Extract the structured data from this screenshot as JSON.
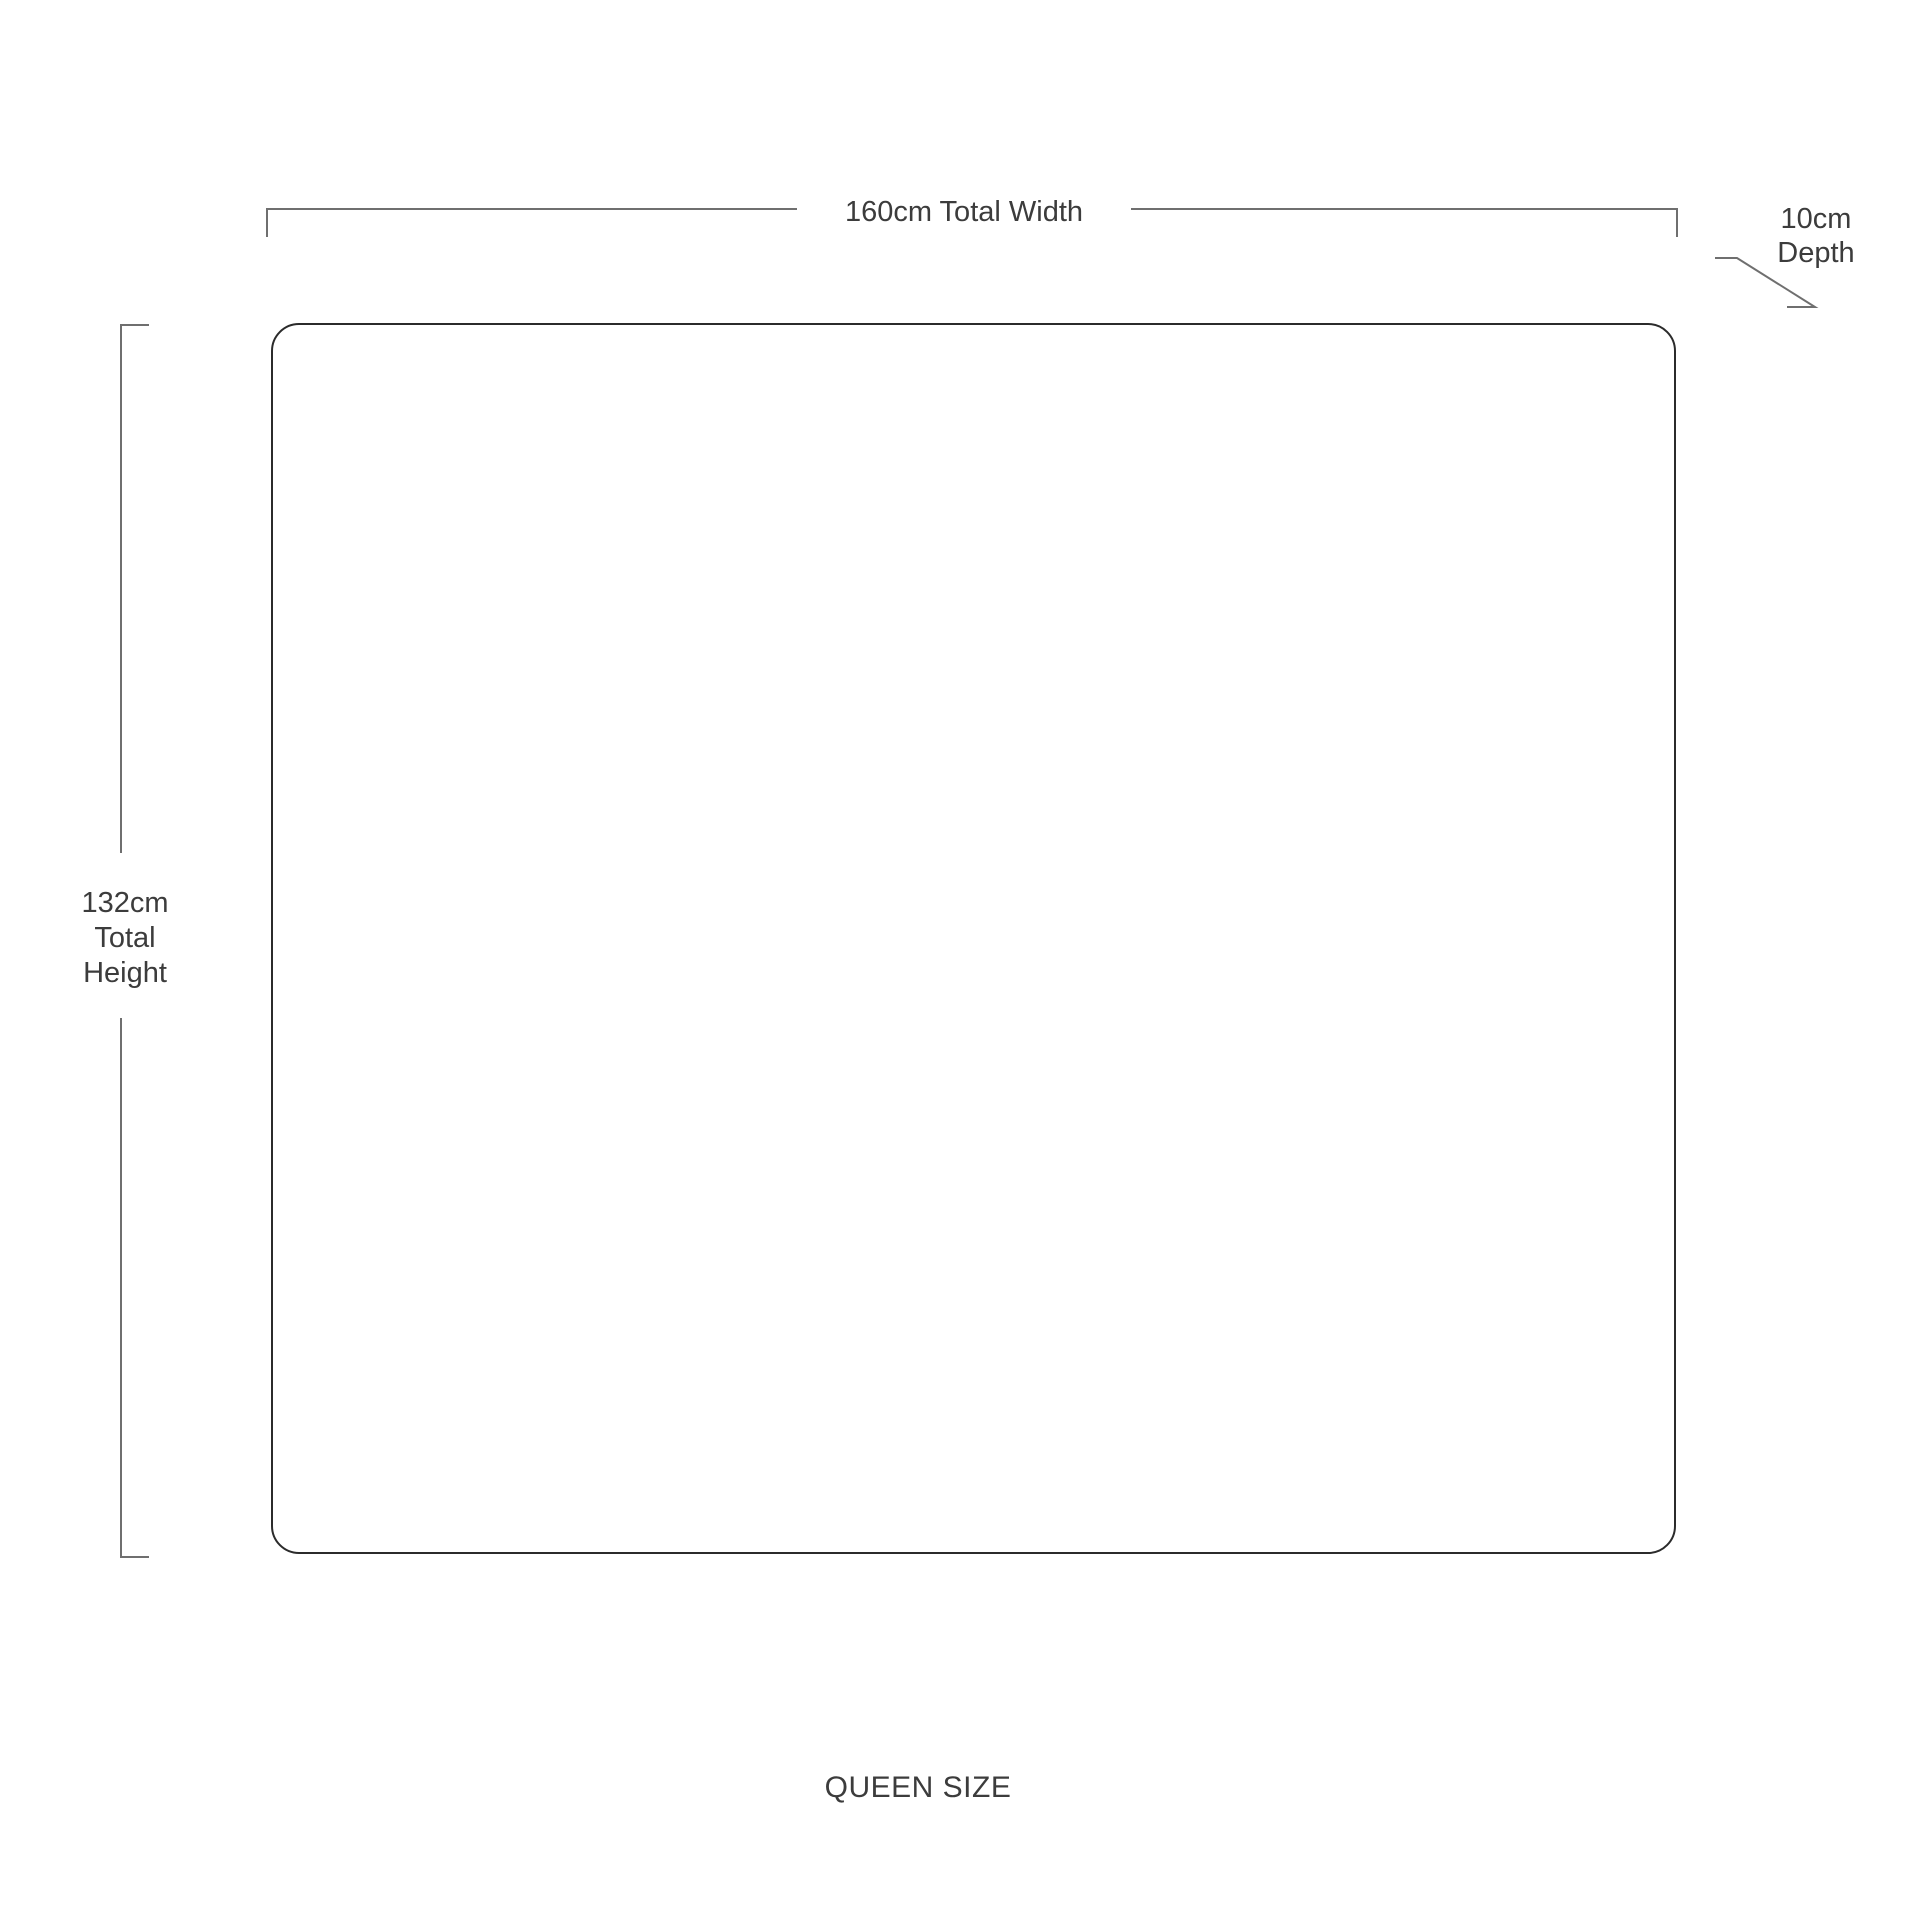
{
  "colors": {
    "background": "#ffffff",
    "outline": "#2b2b2b",
    "dimension_line": "#6f6f6f",
    "text": "#3c3c3c"
  },
  "diagram": {
    "size_caption": "QUEEN SIZE",
    "width_dimension": {
      "label": "160cm Total Width"
    },
    "height_dimension": {
      "lines": [
        "132cm",
        "Total",
        "Height"
      ]
    },
    "depth_dimension": {
      "lines": [
        "10cm",
        "Depth"
      ]
    }
  }
}
